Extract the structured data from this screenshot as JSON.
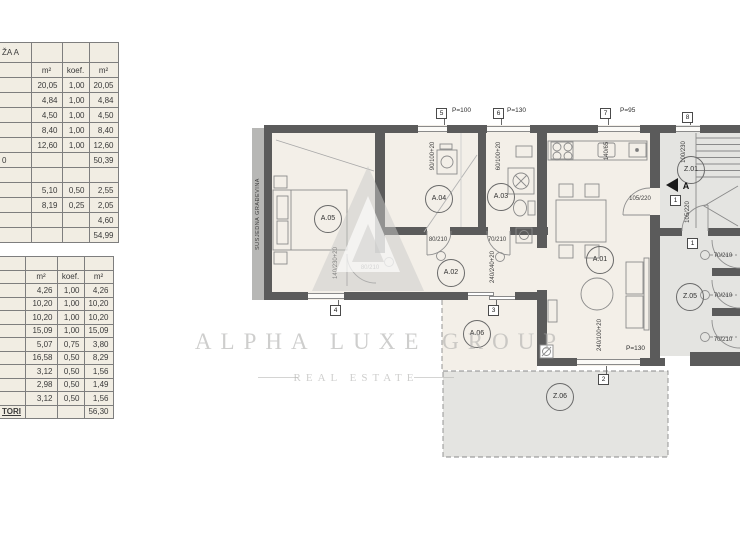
{
  "side_label": "SUSJEDNA GRAĐEVINA",
  "watermark": {
    "line1": "ALPHA LUXE GROUP",
    "line2": "REAL ESTATE"
  },
  "table1": {
    "title": "ŽA A",
    "headers": [
      "",
      "m²",
      "koef.",
      "m²"
    ],
    "rows": [
      [
        "",
        "20,05",
        "1,00",
        "20,05"
      ],
      [
        "",
        "4,84",
        "1,00",
        "4,84"
      ],
      [
        "",
        "4,50",
        "1,00",
        "4,50"
      ],
      [
        "",
        "8,40",
        "1,00",
        "8,40"
      ],
      [
        "",
        "12,60",
        "1,00",
        "12,60"
      ],
      [
        "0",
        "",
        "",
        "50,39"
      ],
      [
        "",
        "",
        "",
        ""
      ],
      [
        "",
        "5,10",
        "0,50",
        "2,55"
      ],
      [
        "",
        "8,19",
        "0,25",
        "2,05"
      ],
      [
        "",
        "",
        "",
        "4,60"
      ],
      [
        "",
        "",
        "",
        "54,99"
      ]
    ]
  },
  "table2": {
    "headers": [
      "",
      "m²",
      "koef.",
      "m²"
    ],
    "rows": [
      [
        "",
        "4,26",
        "1,00",
        "4,26"
      ],
      [
        "",
        "10,20",
        "1,00",
        "10,20"
      ],
      [
        "",
        "10,20",
        "1,00",
        "10,20"
      ],
      [
        "",
        "15,09",
        "1,00",
        "15,09"
      ],
      [
        "",
        "5,07",
        "0,75",
        "3,80"
      ],
      [
        "",
        "16,58",
        "0,50",
        "8,29"
      ],
      [
        "",
        "3,12",
        "0,50",
        "1,56"
      ],
      [
        "",
        "2,98",
        "0,50",
        "1,49"
      ],
      [
        "",
        "3,12",
        "0,50",
        "1,56"
      ],
      [
        "TORI",
        "",
        "",
        "56,30"
      ]
    ]
  },
  "rooms": {
    "a01": "A.01",
    "a02": "A.02",
    "a03": "A.03",
    "a04": "A.04",
    "a05": "A.05",
    "a06": "A.06",
    "z01": "Z.01",
    "z05": "Z.05",
    "z06": "Z.06"
  },
  "markers": {
    "m1": "1",
    "m2": "2",
    "m3": "3",
    "m4": "4",
    "m5": "5",
    "m6": "6",
    "m7": "7",
    "m8": "8"
  },
  "plabels": {
    "p5": "P=100",
    "p6": "P=130",
    "p7": "P=95",
    "p_liv": "P=130"
  },
  "dims": {
    "a05_win": "140/230+20",
    "a05_door": "80/210",
    "a04_door": "80/210",
    "a03_door": "70/210",
    "a04_win": "90/100+20",
    "a03_win": "60/100+20",
    "sink": "140/65",
    "slider": "240/240+20",
    "z01_win": "100/230",
    "entry_a": "105/220",
    "entry_b": "105/220",
    "liv_win": "240/100+20",
    "cor_door": "70/210",
    "entry_letter": "A"
  }
}
